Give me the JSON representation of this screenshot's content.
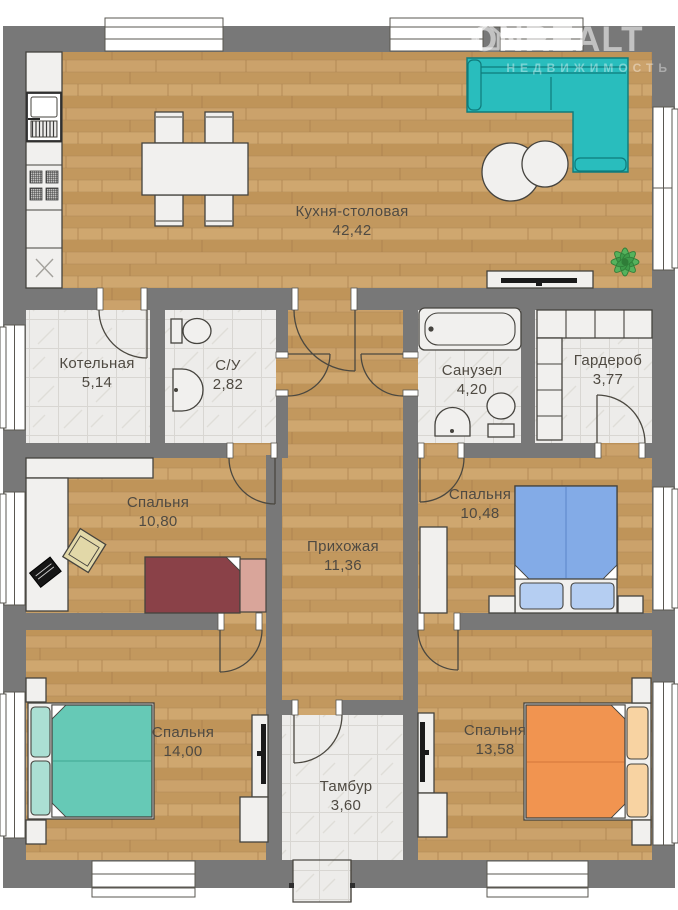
{
  "watermark": {
    "brand": "ONREALT",
    "subtitle": "НЕДВИЖИМОСТЬ"
  },
  "rooms": {
    "kitchen": {
      "name": "Кухня-столовая",
      "area": "42,42"
    },
    "boiler": {
      "name": "Котельная",
      "area": "5,14"
    },
    "wc": {
      "name": "С/У",
      "area": "2,82"
    },
    "bathroom": {
      "name": "Санузел",
      "area": "4,20"
    },
    "wardrobe": {
      "name": "Гардероб",
      "area": "3,77"
    },
    "bedroom_1": {
      "name": "Спальня",
      "area": "10,80"
    },
    "hallway": {
      "name": "Прихожая",
      "area": "11,36"
    },
    "bedroom_2": {
      "name": "Спальня",
      "area": "10,48"
    },
    "bedroom_3": {
      "name": "Спальня",
      "area": "14,00"
    },
    "bedroom_4": {
      "name": "Спальня",
      "area": "13,58"
    },
    "vestibule": {
      "name": "Тамбур",
      "area": "3,60"
    }
  },
  "palette": {
    "wall": "#787878",
    "sofa": "#29bdbd",
    "bed_blue": "#83abe7",
    "bed_teal": "#66c9b6",
    "bed_orange": "#f19450",
    "bed_red": "#8a4148",
    "plant": "#55b25c",
    "label_text": "#4f4a42"
  }
}
